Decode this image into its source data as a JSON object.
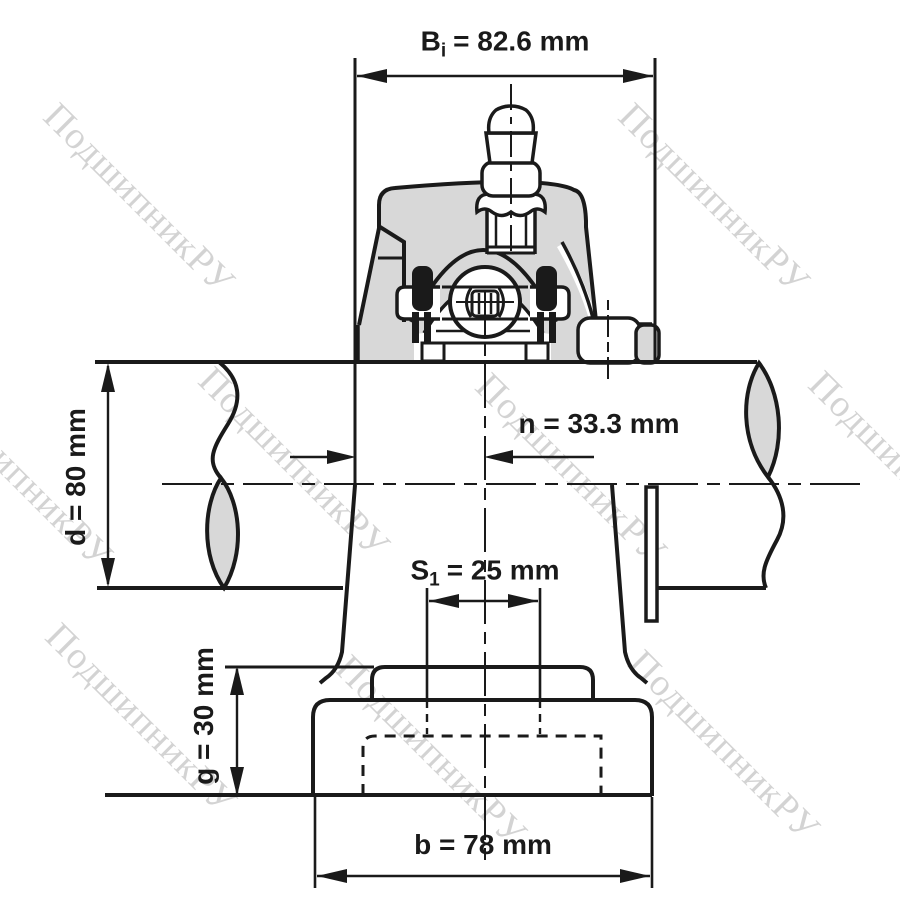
{
  "watermark": {
    "text": "ПодшипникРУ"
  },
  "dimensions": {
    "bi": {
      "symbol": "B",
      "subscript": "i",
      "value": "= 82.6 mm"
    },
    "n": {
      "label": "n = 33.3 mm"
    },
    "d": {
      "label": "d = 80 mm"
    },
    "s1": {
      "symbol": "S",
      "subscript": "1",
      "value": "= 25 mm"
    },
    "g": {
      "label": "g = 30 mm"
    },
    "b": {
      "label": "b = 78 mm"
    }
  },
  "colors": {
    "line": "#1a1a1a",
    "housing_fill": "#d8d8d8",
    "watermark": "#a0a0a0",
    "background": "#ffffff"
  }
}
